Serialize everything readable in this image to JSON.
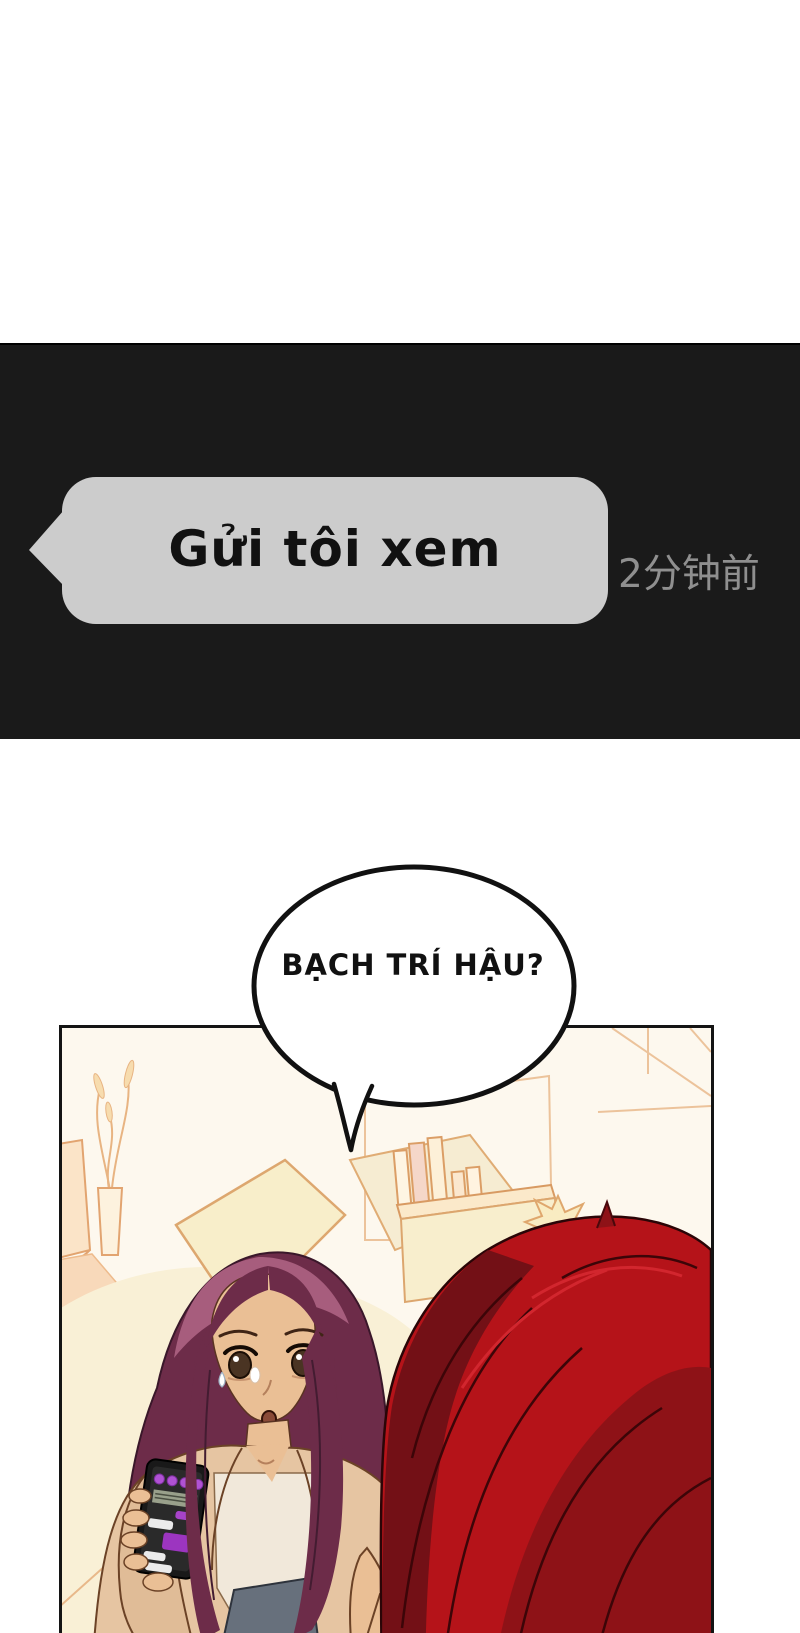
{
  "chat_panel": {
    "message": "Gửi tôi xem",
    "timestamp": "2分钟前",
    "colors": {
      "panel_bg": "#1a1a1a",
      "bubble_bg": "#cccccc",
      "bubble_text": "#111111",
      "timestamp_text": "#8f8f8f"
    }
  },
  "speech_bubble": {
    "text": "BẠCH TRÍ HẬU?",
    "colors": {
      "fill": "#ffffff",
      "outline": "#111111",
      "text": "#111111"
    }
  },
  "scene_panel": {
    "border_color": "#141414",
    "background": "#fdf8ee",
    "line_art_color": "#e2a470",
    "items": [
      "lamp-shade",
      "dried-plant-in-vase",
      "side-table",
      "couch-cushions",
      "bookshelf-with-books",
      "spiky-figurine",
      "woman-holding-phone",
      "red-haired-person-foreground"
    ],
    "woman": {
      "hair_color": "#6d2c49",
      "hair_highlight": "#a75d7d",
      "skin": "#eabf95",
      "jacket": "#e6c5a2",
      "inner_top": "#f1e8da",
      "jeans": "#67707c"
    },
    "red_haired_person": {
      "hair_color": "#b51319",
      "hair_shadow_dark": "#731016",
      "hair_shadow_mid": "#8e1217"
    },
    "phone": {
      "body": "#191919",
      "screen": "#2a2a2a",
      "accent_purple": "#a743c9",
      "bubble_light": "#ebebeb",
      "screenshot_block": "#99a08b"
    }
  }
}
